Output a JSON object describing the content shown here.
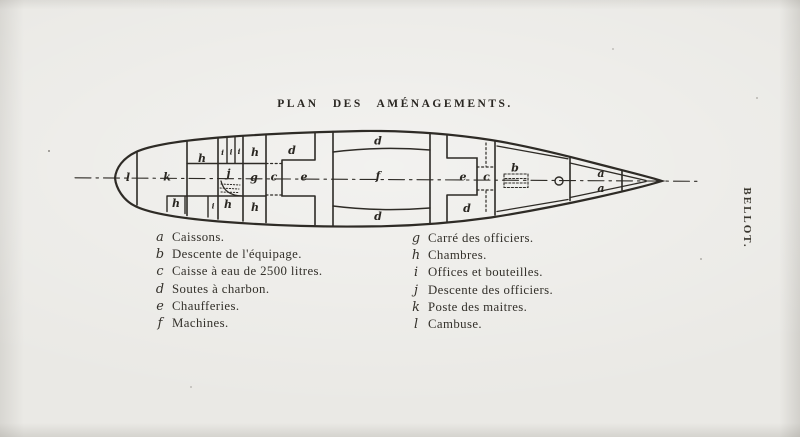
{
  "page": {
    "background": "#eae9e5",
    "ink": "#2e2b26"
  },
  "title": "PLAN DES AMÉNAGEMENTS.",
  "side_label": "BELLOT.",
  "ship": {
    "labels": [
      "l",
      "k",
      "h",
      "i",
      "i",
      "i",
      "h",
      "d",
      "j",
      "g",
      "c",
      "e",
      "d",
      "f",
      "d",
      "e",
      "c",
      "d",
      "b",
      "a",
      "a",
      "h",
      "i",
      "h",
      "h"
    ]
  },
  "legend": {
    "left": [
      {
        "letter": "a",
        "text": "Caissons."
      },
      {
        "letter": "b",
        "text": "Descente de l'équipage."
      },
      {
        "letter": "c",
        "text": "Caisse à eau de 2500 litres."
      },
      {
        "letter": "d",
        "text": "Soutes à charbon."
      },
      {
        "letter": "e",
        "text": "Chaufferies."
      },
      {
        "letter": "f",
        "text": "Machines."
      }
    ],
    "right": [
      {
        "letter": "g",
        "text": "Carré des officiers."
      },
      {
        "letter": "h",
        "text": "Chambres."
      },
      {
        "letter": "i",
        "text": "Offices et bouteilles."
      },
      {
        "letter": "j",
        "text": "Descente des officiers."
      },
      {
        "letter": "k",
        "text": "Poste des maitres."
      },
      {
        "letter": "l",
        "text": "Cambuse."
      }
    ]
  }
}
